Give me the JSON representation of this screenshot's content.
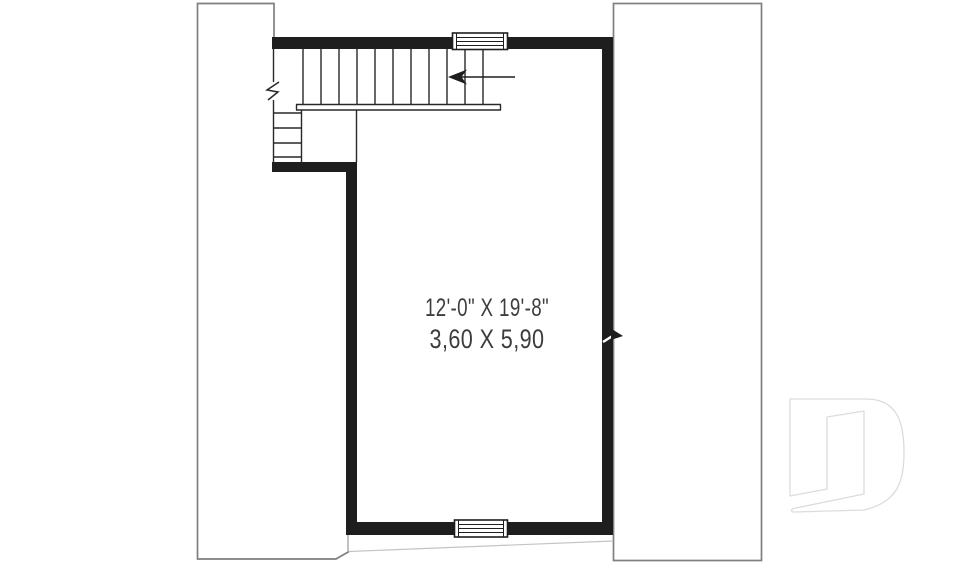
{
  "plan": {
    "dimensions_imperial": "12'-0\" X 19'-8\"",
    "dimensions_metric": "3,60 X 5,90"
  },
  "graphics": {
    "stair_arrow": "stair-direction-arrow",
    "windows": [
      "top-wall-window",
      "bottom-wall-window"
    ],
    "wall_breaks": [
      "left-wall-break-mark",
      "right-wall-break-mark"
    ],
    "watermark": "d-logo-watermark"
  },
  "colors": {
    "wall": "#1e1e1e",
    "stair_line": "#282828",
    "roof_outline": "#7f7f7f",
    "faint_roofline": "#c4c4c4",
    "logo_outline": "#dcdcdc",
    "text": "#3d3d3d",
    "background": "#ffffff"
  }
}
